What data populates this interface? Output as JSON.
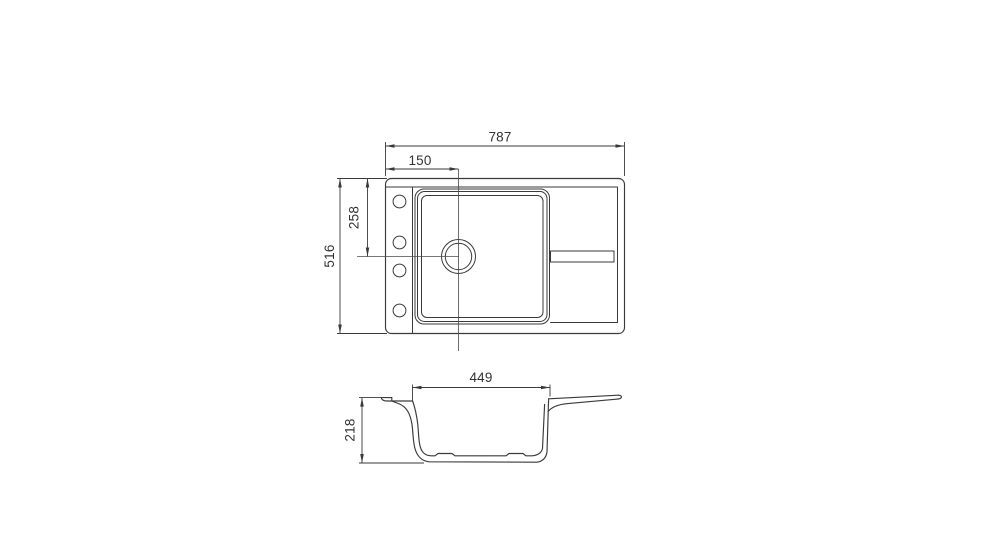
{
  "meta": {
    "background_color": "#ffffff",
    "line_color": "#3a3a3a",
    "text_color": "#333333"
  },
  "plan_view": {
    "dim_overall_width": "787",
    "dim_drain_offset_from_left": "150",
    "dim_drain_offset_from_top": "258",
    "dim_overall_depth": "516",
    "tap_hole_count": "4"
  },
  "section_view": {
    "dim_bowl_top_width": "449",
    "dim_overall_height": "218"
  }
}
